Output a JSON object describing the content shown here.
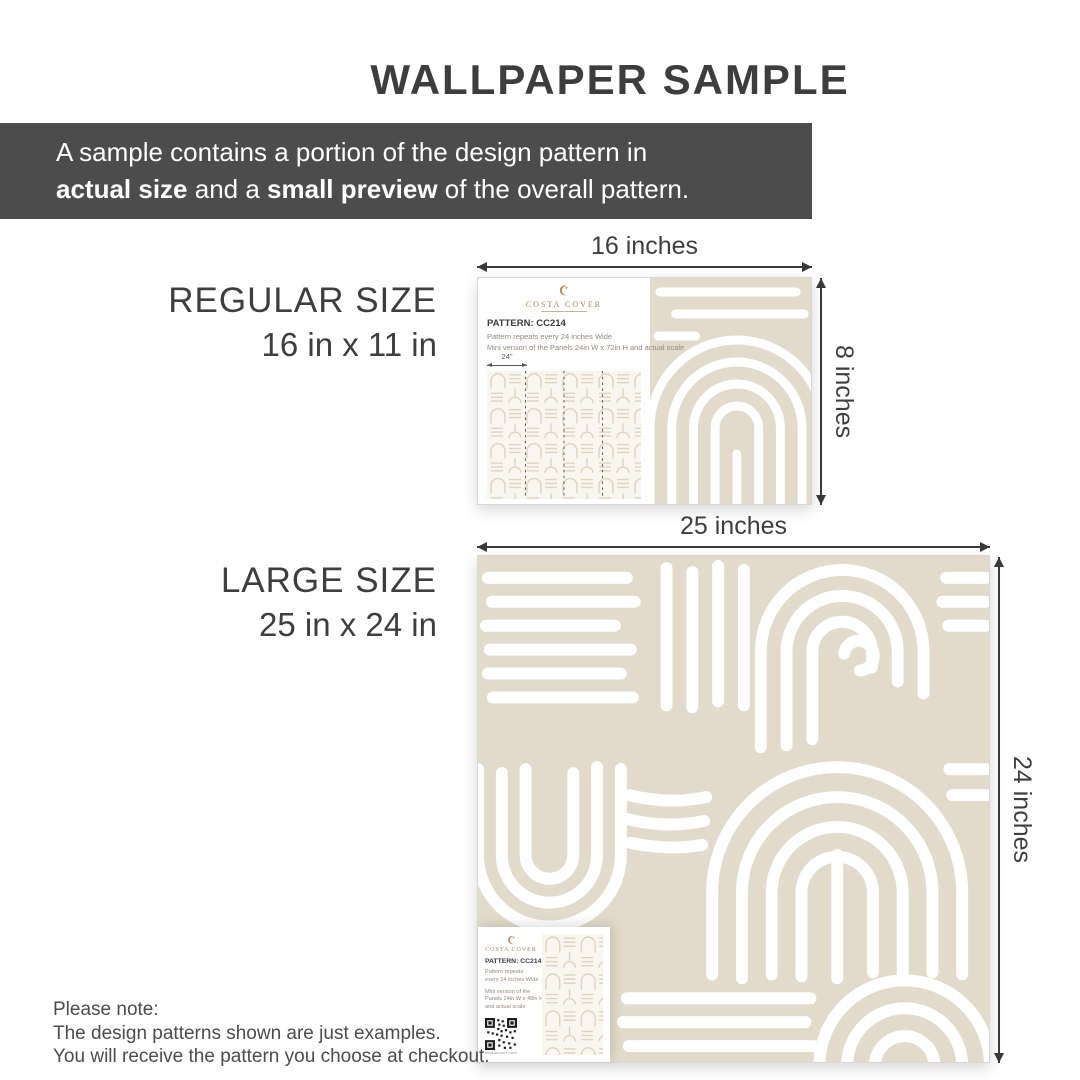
{
  "title": "WALLPAPER SAMPLE",
  "banner": {
    "text_line1": "A sample contains a portion of the design pattern in",
    "bold1": "actual size",
    "mid": " and a ",
    "bold2": "small preview",
    "tail": " of the overall pattern."
  },
  "regular": {
    "size_name": "REGULAR SIZE",
    "size_dims": "16 in x 11 in",
    "width_label": "16 inches",
    "height_label": "8 inches",
    "card": {
      "brand": "COSTA COVER",
      "pattern_code": "PATTERN: CC214",
      "line1": "Pattern repeats every 24 inches Wide",
      "line2": "Mini version of the Panels 24in W x 72in H and actual scale",
      "panel_width_label": "24\""
    }
  },
  "large": {
    "size_name": "LARGE SIZE",
    "size_dims": "25 in x 24 in",
    "width_label": "25 inches",
    "height_label": "24 inches",
    "card": {
      "brand": "COSTA COVER",
      "pattern_code": "PATTERN: CC214",
      "line1": "Pattern repeats",
      "line2": "every 24 inches Wide",
      "line3": "Mini version of the",
      "line4": "Panels 24in W x 48in H",
      "line5": "and actual scale",
      "qr_caption": "costacover.com"
    }
  },
  "note": {
    "line1": "Please note:",
    "line2": "The design patterns shown are just examples.",
    "line3": "You will receive the pattern you choose at checkout."
  },
  "colors": {
    "pattern_beige": "#e2dbcb",
    "banner_gray": "#4c4c4c",
    "text_dark": "#3d3d3d",
    "brand_gold": "#a9835a"
  }
}
